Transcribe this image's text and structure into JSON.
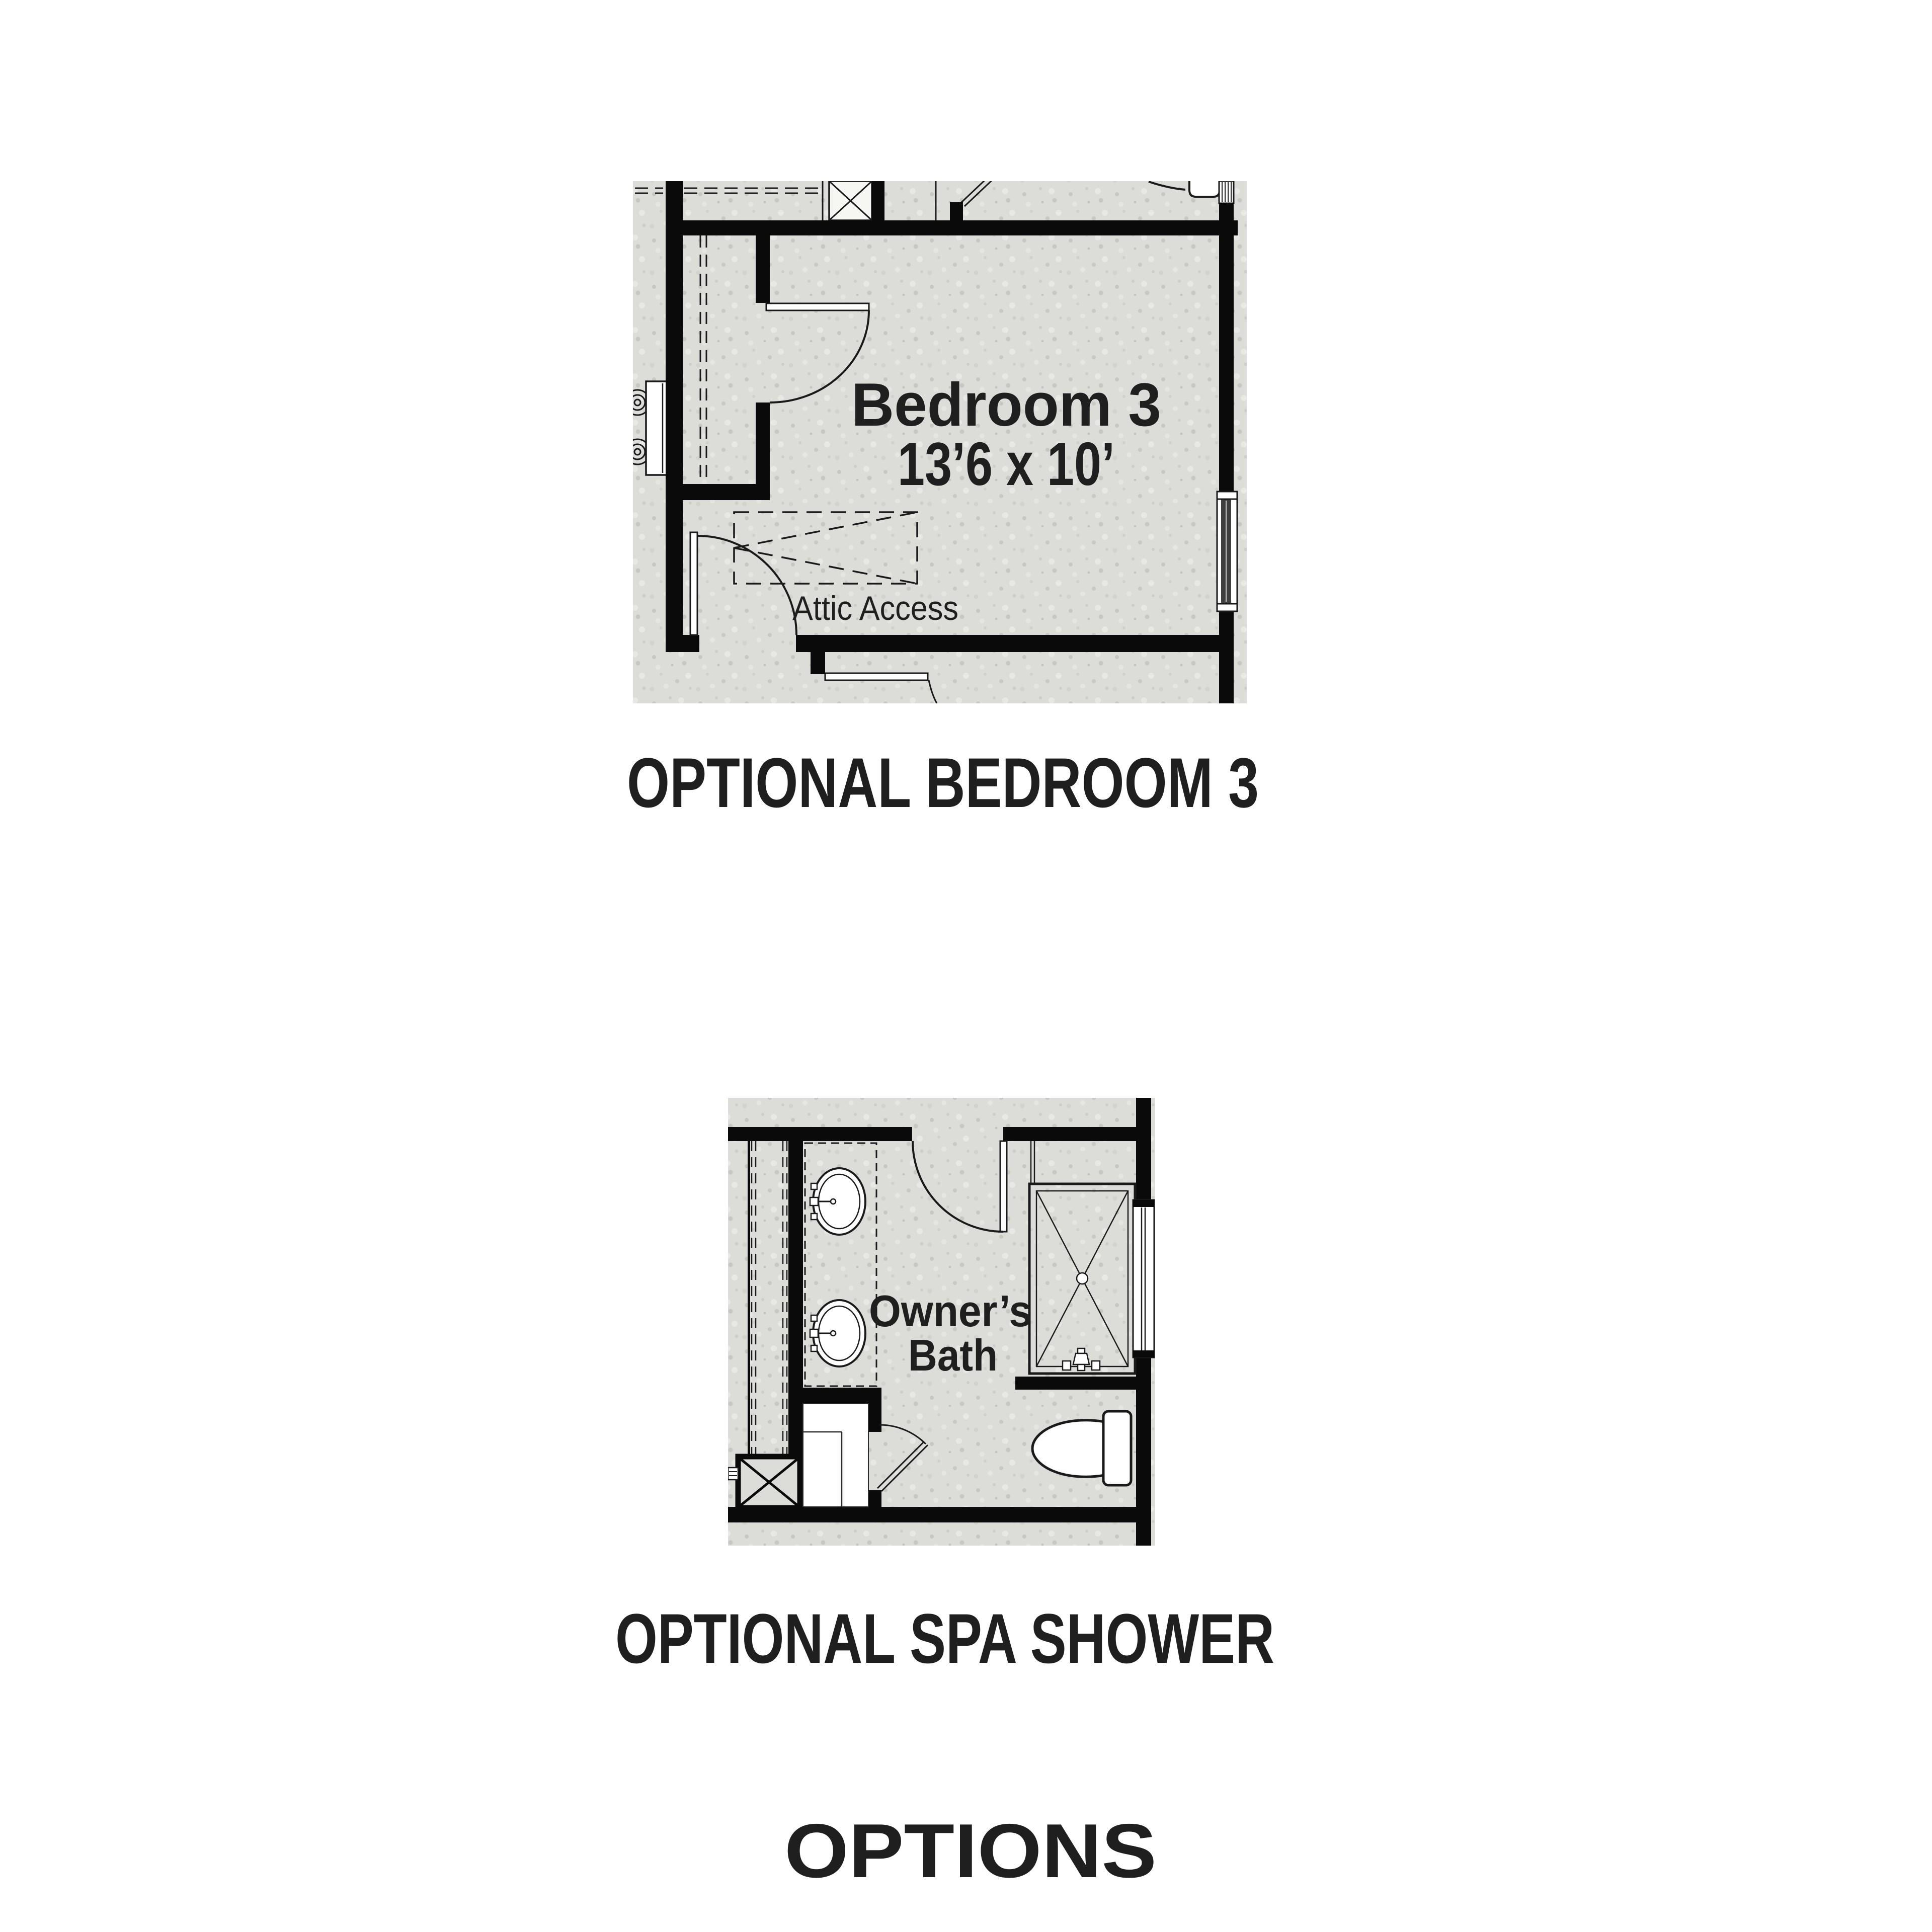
{
  "colors": {
    "background": "#ffffff",
    "floor_fill": "#dcddd8",
    "speckle_dark": "#c7c8c2",
    "speckle_light": "#e8e9e4",
    "wall": "#0a0a0a",
    "line": "#1a1a1a",
    "text": "#1f1f1f"
  },
  "plans": [
    {
      "id": "optional-bedroom-3",
      "caption": "OPTIONAL BEDROOM 3",
      "room": {
        "name": "Bedroom 3",
        "dimensions": "13’6 x 10’"
      },
      "annotations": {
        "attic_access": "Attic Access"
      }
    },
    {
      "id": "optional-spa-shower",
      "caption": "OPTIONAL SPA SHOWER",
      "room": {
        "name_line1": "Owner’s",
        "name_line2": "Bath"
      }
    }
  ],
  "footer": {
    "title": "OPTIONS"
  }
}
